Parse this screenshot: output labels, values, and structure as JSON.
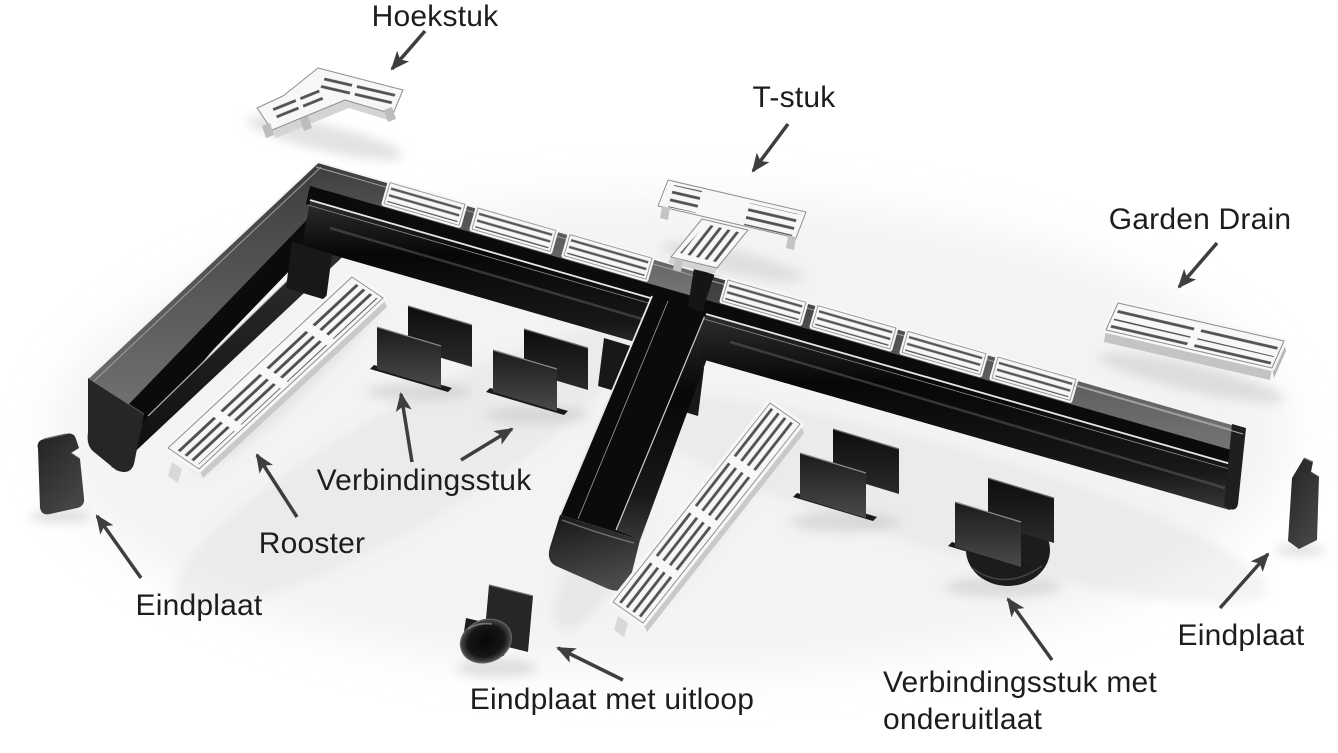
{
  "diagram": {
    "type": "product-parts-diagram",
    "product_name": "Garden Drain",
    "colors": {
      "background": "#ffffff",
      "channel_black": "#141414",
      "grate_white": "#f7f7f7",
      "arrow": "#3e3e3e",
      "label_text": "#1d1d1d"
    },
    "labels": {
      "hoekstuk": "Hoekstuk",
      "t_stuk": "T-stuk",
      "garden_drain": "Garden Drain",
      "verbindingsstuk": "Verbindingsstuk",
      "rooster": "Rooster",
      "eindplaat_left": "Eindplaat",
      "eindplaat_met_uitloop": "Eindplaat met uitloop",
      "verbindingsstuk_met_onderuitlaat": {
        "line1": "Verbindingsstuk met",
        "line2": "onderuitlaat"
      },
      "eindplaat_right": "Eindplaat"
    }
  }
}
